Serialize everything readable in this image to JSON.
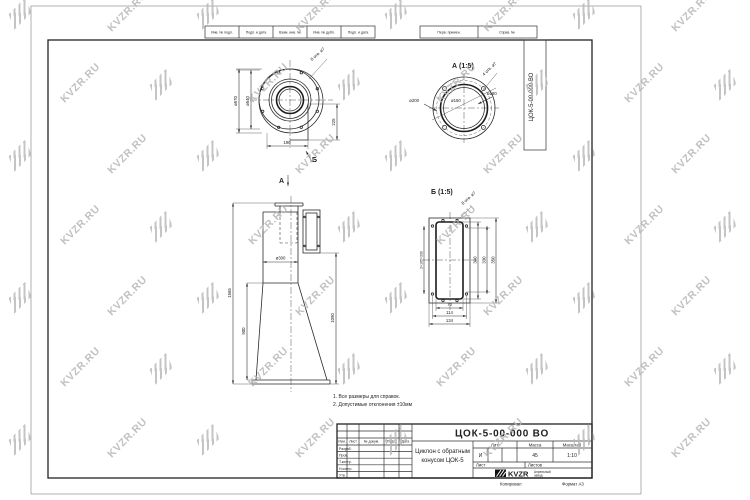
{
  "colors": {
    "line": "#2a2a2a",
    "watermark": "#b6b6b6",
    "paper": "#ffffff"
  },
  "watermark": {
    "text": "KVZR.RU"
  },
  "filing_strip": {
    "cells": [
      "Инв. № подл.",
      "Подп. и дата",
      "Взам. инв. №",
      "Инв. № дубл.",
      "Подп. и дата"
    ]
  },
  "ref_strip": {
    "cells": [
      "Перв. примен.",
      "Справ. №"
    ]
  },
  "designation_stamp": "ЦОК-5-00-000 ВО",
  "views": {
    "top_view": {
      "view_arrow": "Б",
      "dia_outer": "ø570",
      "dia_body": "ø540",
      "width": "190",
      "height": "225",
      "holes_note": "8 отв. ø7"
    },
    "front_view": {
      "view_arrow": "А",
      "dia_pipe": "ø300",
      "cone_height": "900",
      "total_height": "1565",
      "right_height": "1090"
    },
    "view_a": {
      "title": "А (1:5)",
      "dia_flange": "ø200",
      "dia_pipe": "ø150",
      "dia_bolts": "ø180",
      "holes_note": "4 отв. ø7"
    },
    "view_b": {
      "title": "Б (1:5)",
      "slot_width": "70",
      "holes_span": "114",
      "plate_width": "134",
      "slot_height": "300",
      "holes_height": "330",
      "plate_height": "350",
      "holes_pitch": "2×165=330",
      "holes_note": "8 отв. ø7"
    }
  },
  "notes": {
    "line1": "1. Все размеры для справок.",
    "line2": "2. Допустимые отклонения ±10мм"
  },
  "title_block": {
    "designation": "ЦОК-5-00-000 ВО",
    "name_line1": "Циклон с обратным",
    "name_line2": "конусом ЦОК-5",
    "header_cells": [
      "Изм.",
      "Лист",
      "№ докум.",
      "Подп.",
      "Дата"
    ],
    "rows": [
      "Разраб.",
      "Пров.",
      "Т.контр.",
      "Н.контр.",
      "Утв."
    ],
    "lit_header": "Лит.",
    "mass_header": "Масса",
    "scale_header": "Масштаб",
    "lit": "И",
    "mass": "45",
    "scale": "1:10",
    "sheet_label": "Лист",
    "sheets_label": "Листов",
    "company_logo": "KVZR",
    "company_line1": "Апрельный",
    "company_line2": "завод",
    "copied_label": "Копировал",
    "format_label": "Формат А3"
  }
}
